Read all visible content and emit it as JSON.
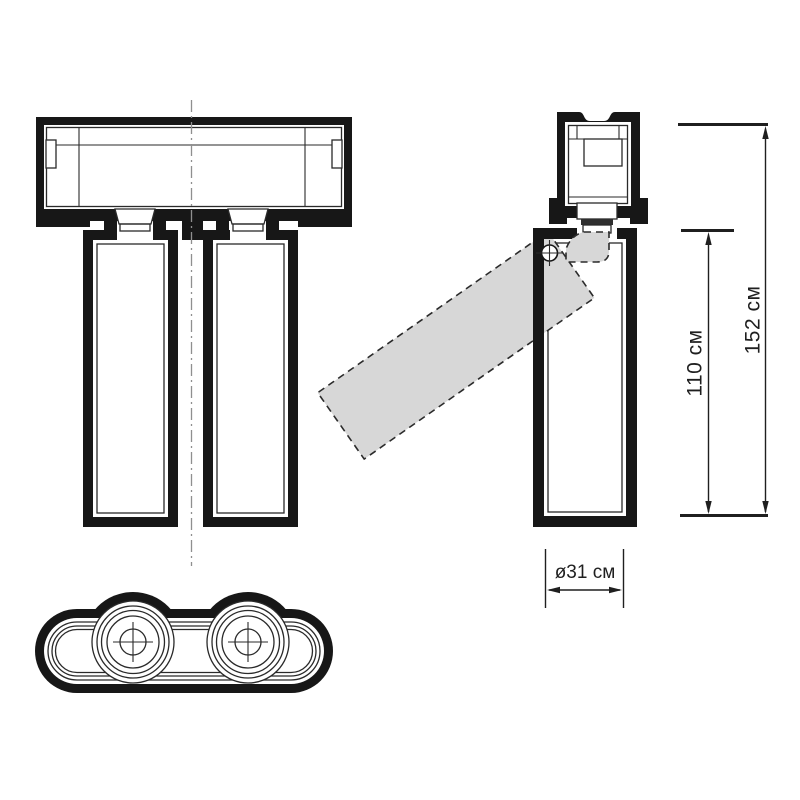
{
  "drawing": {
    "labels": {
      "total_height": "152 см",
      "body_height": "110 см",
      "diameter": "ø31 см"
    },
    "colors": {
      "line": "#171717",
      "ghost_fill": "#d7d7d7",
      "cap_fill": "#cfcfcf",
      "centerline": "#8f8f8f",
      "background": "#ffffff"
    }
  }
}
